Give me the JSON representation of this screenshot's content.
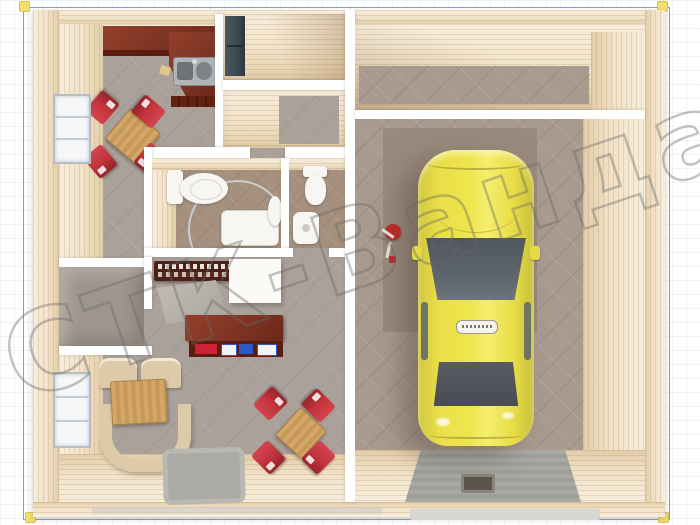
{
  "image": {
    "type": "3d-floor-plan-top-view",
    "subject": "one-storey house layout with kitchen, two bathrooms, study, living room and attached garage with a yellow car"
  },
  "watermark": {
    "text": "СТК-Ванда"
  },
  "colors": {
    "frame": "#8f9db4",
    "pin": "#f1e06a",
    "cream": "#f3e4ca",
    "creamDark": "#e2cda9",
    "wallWhite": "#ffffff",
    "tile": "#a9a19a",
    "bathTile": "#a5907e",
    "storageFloor": "#9e968e",
    "garageFloor": "#a89a8e",
    "garagePad": "#958779",
    "ramp": "#9e9e9a",
    "mahogany": "#7e3424",
    "mahoganyDark": "#5a1d10",
    "chairRed": "#c2333a",
    "wood": "#c89858",
    "sofa": "#dccaa9",
    "slate": "#3d4a52",
    "carYellow": "#efe54d",
    "carGlass": "#5d646b",
    "watermark": "rgba(104,104,104,0.5)"
  },
  "objects": {
    "rooms": [
      "kitchen",
      "entry-hall",
      "corridor",
      "bathroom",
      "toilet-room",
      "storage-room",
      "study",
      "living-room",
      "garage",
      "garage-storage"
    ],
    "furniture": [
      "kitchen-counter",
      "kitchen-sink",
      "dining-table",
      "red-chairs",
      "wardrobe",
      "toilet",
      "shower-cabin",
      "washbasin",
      "desk",
      "book-shelf",
      "white-cabinet",
      "sofa",
      "coffee-table",
      "doormat",
      "windows",
      "yellow-car",
      "garage-ramp",
      "drain-hatch",
      "red-cart"
    ]
  }
}
